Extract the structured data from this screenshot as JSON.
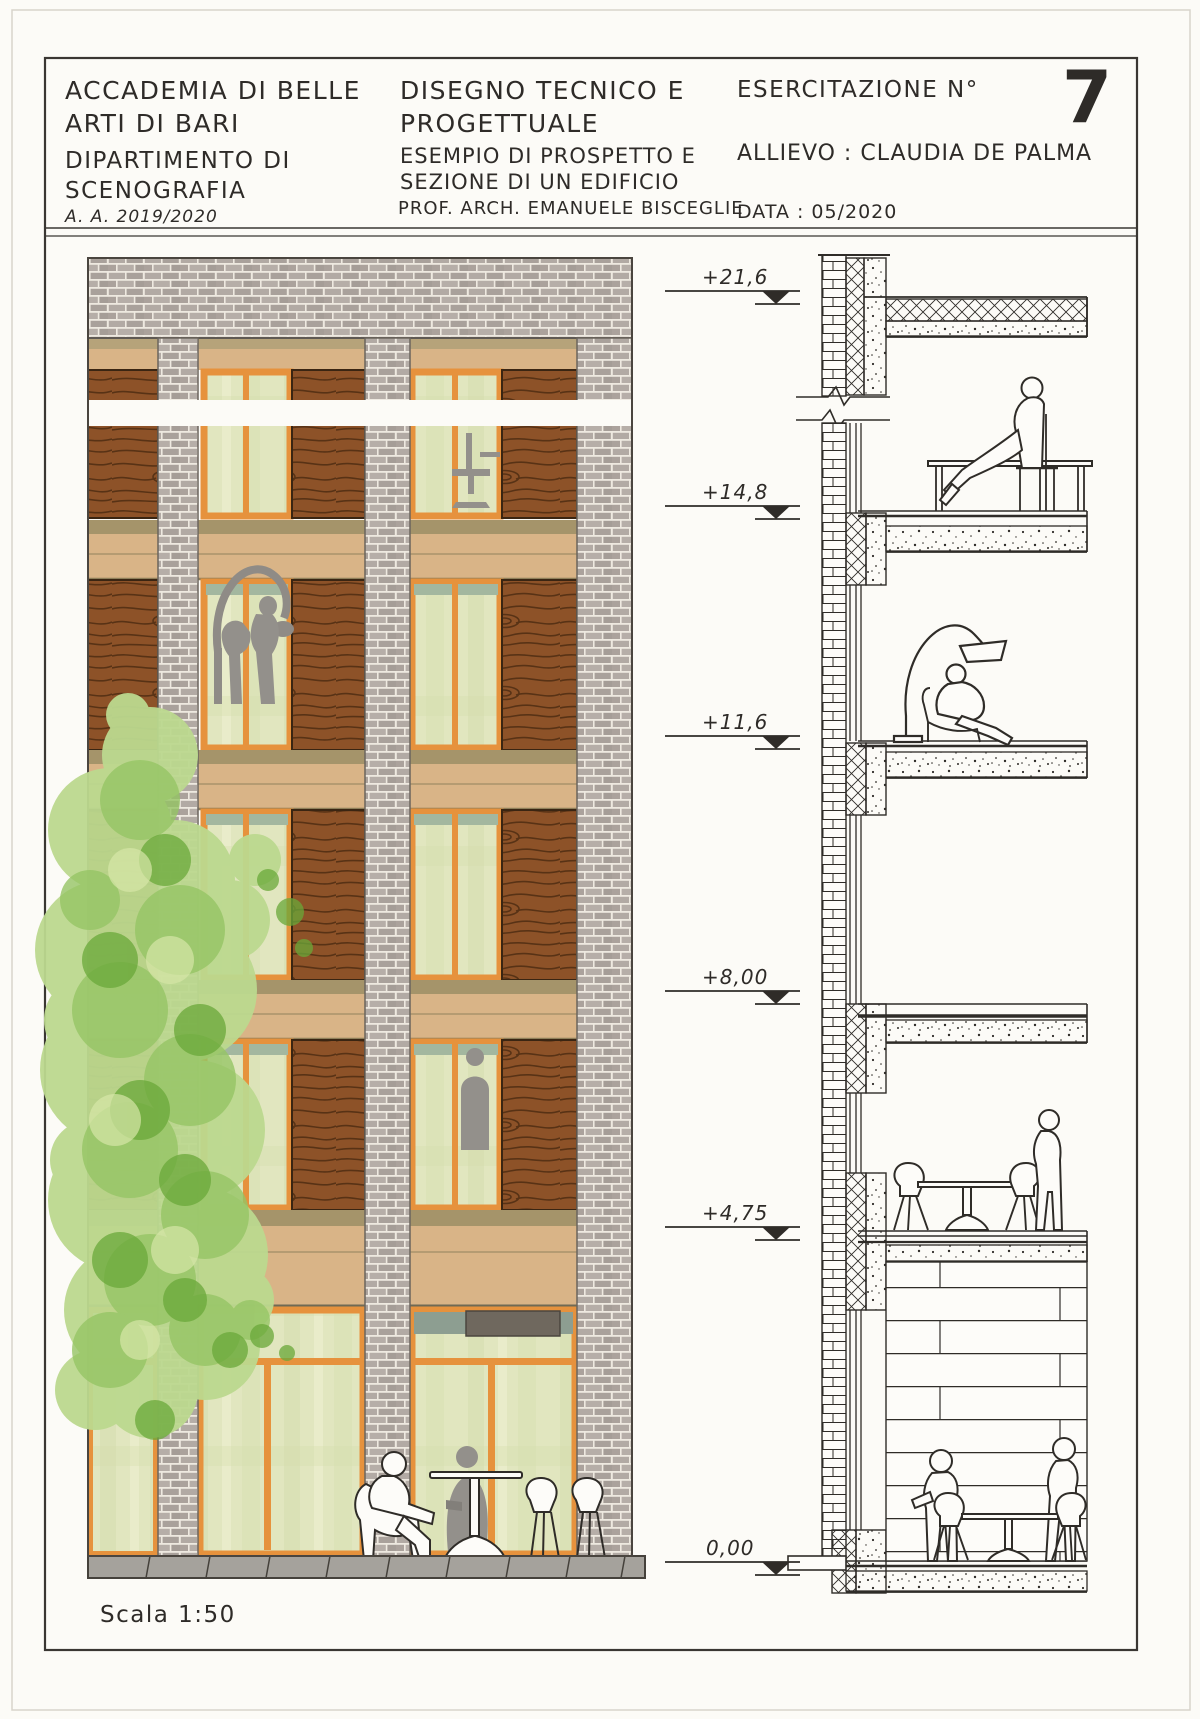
{
  "title_block": {
    "institution": [
      "ACCADEMIA DI BELLE",
      "ARTI DI BARI"
    ],
    "department": [
      "DIPARTIMENTO DI",
      "SCENOGRAFIA"
    ],
    "academic_year": "A. A. 2019/2020",
    "course": [
      "DISEGNO TECNICO E",
      "PROGETTUALE"
    ],
    "subject": [
      "ESEMPIO DI PROSPETTO E",
      "SEZIONE DI UN EDIFICIO"
    ],
    "professor": "PROF. ARCH. EMANUELE BISCEGLIE",
    "exercise_label": "ESERCITAZIONE N°",
    "exercise_number": "7",
    "student": "ALLIEVO : CLAUDIA DE PALMA",
    "date": "DATA : 05/2020"
  },
  "elevation": {
    "scale_label": "Scala 1:50",
    "markers": [
      "+21,6",
      "+14,8",
      "+11,6",
      "+8,00",
      "+4,75",
      "0,00"
    ]
  },
  "colors": {
    "ink": "#2f2c28",
    "brick": "#b2aaa4",
    "mortar": "#eee9e0",
    "wood": "#8d5228",
    "wood_grain": "#4e2c11",
    "glass": "#e1e6bf",
    "frame_orange": "#e6923d",
    "spandrel_tan": "#d9b487",
    "spandrel_top": "#a5946a",
    "tree_light": "#bcd98f",
    "tree_mid": "#96c565",
    "tree_dark": "#6aa839",
    "silhouette_gray": "#93908b",
    "sidewalk": "#a5a29c"
  }
}
